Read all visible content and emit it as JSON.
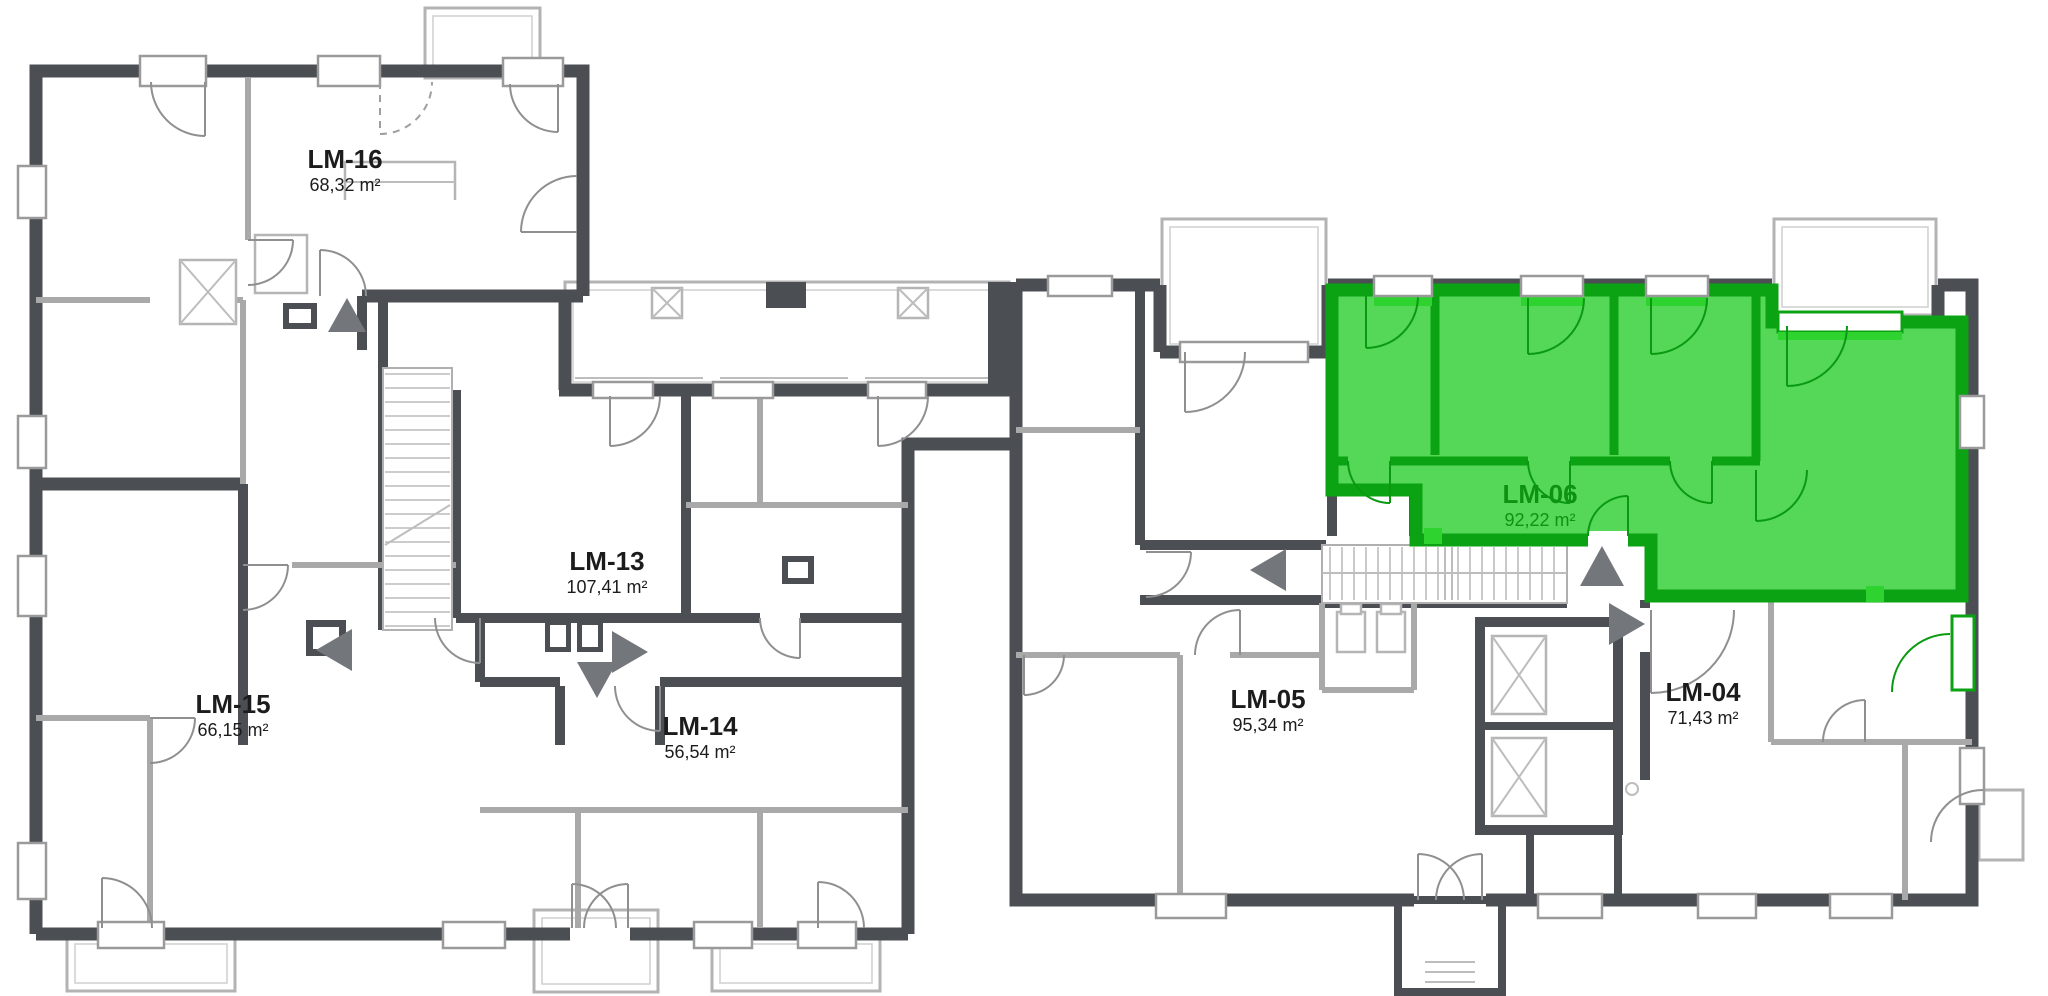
{
  "plan": {
    "background": "#ffffff",
    "wall_color": "#4b4f54",
    "partition_color": "#a9a9a9",
    "arrow_color": "#73777b",
    "units": [
      {
        "key": "lm-16",
        "label": "LM-16",
        "area": "68,32 m²",
        "highlighted": false
      },
      {
        "key": "lm-13",
        "label": "LM-13",
        "area": "107,41 m²",
        "highlighted": false
      },
      {
        "key": "lm-15",
        "label": "LM-15",
        "area": "66,15 m²",
        "highlighted": false
      },
      {
        "key": "lm-14",
        "label": "LM-14",
        "area": "56,54 m²",
        "highlighted": false
      },
      {
        "key": "lm-05",
        "label": "LM-05",
        "area": "95,34 m²",
        "highlighted": false
      },
      {
        "key": "lm-06",
        "label": "LM-06",
        "area": "92,22 m²",
        "highlighted": true
      },
      {
        "key": "lm-04",
        "label": "LM-04",
        "area": "71,43 m²",
        "highlighted": false
      }
    ],
    "highlight": {
      "unit": "LM-06",
      "fill": "#55d757",
      "wall": "#0ba313",
      "label_color": "#0e9212"
    }
  }
}
